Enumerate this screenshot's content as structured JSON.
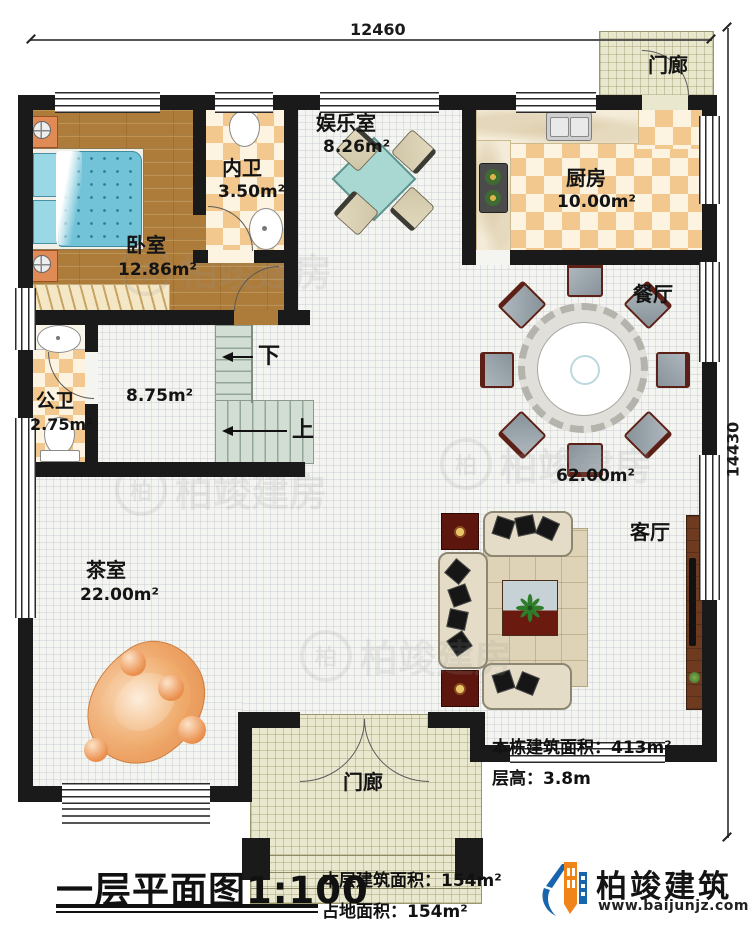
{
  "dimensions": {
    "width_label": "12460",
    "height_label": "14430"
  },
  "rooms": {
    "entertainment": {
      "name": "娱乐室",
      "area": "8.26m²"
    },
    "inner_bath": {
      "name": "内卫",
      "area": "3.50m²"
    },
    "bedroom": {
      "name": "卧室",
      "area": "12.86m²"
    },
    "kitchen": {
      "name": "厨房",
      "area": "10.00m²"
    },
    "porch_top": {
      "name": "门廊"
    },
    "dining": {
      "name": "餐厅"
    },
    "public_bath": {
      "name": "公卫",
      "area": "2.75m²"
    },
    "hall": {
      "area": "8.75m²"
    },
    "great_room": {
      "area": "62.00m²"
    },
    "living": {
      "name": "客厅"
    },
    "tea": {
      "name": "茶室",
      "area": "22.00m²"
    },
    "porch_bottom": {
      "name": "门廊"
    }
  },
  "stairs": {
    "down_label": "下",
    "up_label": "上"
  },
  "info": {
    "total_area_label": "本栋建筑面积：",
    "total_area_value": "413m²",
    "height_label": "层高：",
    "height_value": "3.8m"
  },
  "footer": {
    "plan_title": "一层平面图",
    "plan_scale": "1:100",
    "floor_area_label": "本层建筑面积：",
    "floor_area_value": "154m²",
    "land_area_label": "占地面积：",
    "land_area_value": "154m²"
  },
  "brand": {
    "name": "柏竣建筑",
    "website": "www.baijunjz.com",
    "mark": "柏"
  },
  "watermark": {
    "text": "柏竣建房",
    "mark": "柏"
  }
}
